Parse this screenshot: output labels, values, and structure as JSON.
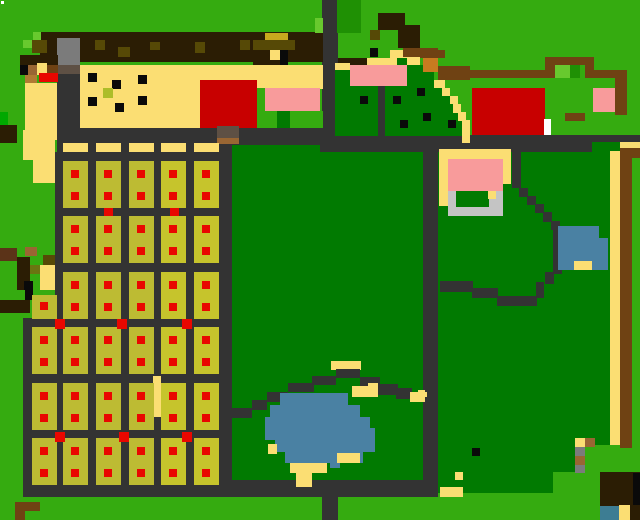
{
  "scene": {
    "width": 640,
    "height": 520,
    "background": "#35AB10",
    "description": "pixel-art top-down farm map"
  },
  "palette": {
    "G": "#35AB10",
    "G2": "#00A800",
    "GL": "#68C92E",
    "GM": "#1F9004",
    "GD": "#017A01",
    "RD": "#333333",
    "SA": "#FBDE73",
    "OL": "#BDBB33",
    "OL2": "#C6C42C",
    "RE": "#E90700",
    "RB": "#C80000",
    "PK": "#F89B9B",
    "BL": "#4A81A3",
    "BL2": "#3D7D93",
    "GY": "#7B7B7B",
    "GYL": "#C4C4C4",
    "GYB": "#5E5044",
    "BR": "#6F4213",
    "BRD": "#2B1D04",
    "BRR": "#5B3318",
    "ORN": "#C87B20",
    "OLD": "#564906",
    "OL3": "#6A7511",
    "YDK": "#C9A81E",
    "BRM": "#996633",
    "TAN": "#B07B33",
    "BK": "#0A0A0A",
    "WH": "#FFFFFF",
    "ADB": "#ADBD29"
  },
  "rects": [
    [
      57,
      128,
      266,
      33,
      "RD"
    ],
    [
      55,
      152,
      177,
      166,
      "RD"
    ],
    [
      23,
      318,
      209,
      179,
      "RD"
    ],
    [
      232,
      145,
      88,
      335,
      "GD"
    ],
    [
      320,
      152,
      103,
      328,
      "GD"
    ],
    [
      219,
      152,
      13,
      345,
      "RD"
    ],
    [
      423,
      152,
      15,
      345,
      "RD"
    ],
    [
      438,
      152,
      172,
      320,
      "GD"
    ],
    [
      438,
      472,
      115,
      21,
      "GD"
    ],
    [
      219,
      480,
      219,
      17,
      "RD"
    ],
    [
      322,
      497,
      16,
      23,
      "RD"
    ],
    [
      322,
      0,
      16,
      152,
      "RD"
    ],
    [
      338,
      135,
      302,
      17,
      "RD"
    ],
    [
      57,
      73,
      23,
      55,
      "RD"
    ],
    [
      1,
      1,
      3,
      3,
      "WH"
    ],
    [
      0,
      112,
      8,
      13,
      "G2"
    ],
    [
      0,
      125,
      17,
      18,
      "BRD"
    ],
    [
      23,
      130,
      32,
      30,
      "SA"
    ],
    [
      33,
      160,
      22,
      23,
      "SA"
    ],
    [
      40,
      32,
      283,
      30,
      "BRD"
    ],
    [
      33,
      32,
      8,
      9,
      "GL"
    ],
    [
      23,
      40,
      10,
      8,
      "GL"
    ],
    [
      315,
      18,
      8,
      15,
      "GL"
    ],
    [
      32,
      40,
      15,
      13,
      "OLD"
    ],
    [
      95,
      40,
      10,
      10,
      "OLD"
    ],
    [
      118,
      47,
      12,
      10,
      "OLD"
    ],
    [
      150,
      42,
      10,
      8,
      "OLD"
    ],
    [
      195,
      42,
      10,
      11,
      "OLD"
    ],
    [
      265,
      33,
      23,
      8,
      "YDK"
    ],
    [
      240,
      40,
      10,
      10,
      "OLD"
    ],
    [
      253,
      40,
      42,
      10,
      "OLD"
    ],
    [
      270,
      50,
      10,
      10,
      "SA"
    ],
    [
      280,
      50,
      8,
      21,
      "BK"
    ],
    [
      253,
      62,
      27,
      9,
      "BRD"
    ],
    [
      57,
      38,
      23,
      27,
      "GY"
    ],
    [
      57,
      65,
      23,
      9,
      "GYB"
    ],
    [
      20,
      55,
      38,
      10,
      "BRD"
    ],
    [
      25,
      65,
      12,
      10,
      "BRM"
    ],
    [
      37,
      63,
      10,
      12,
      "SA"
    ],
    [
      47,
      65,
      11,
      10,
      "BR"
    ],
    [
      20,
      65,
      8,
      10,
      "BK"
    ],
    [
      39,
      73,
      19,
      9,
      "RE"
    ],
    [
      25,
      75,
      12,
      8,
      "TAN"
    ],
    [
      25,
      83,
      32,
      57,
      "SA"
    ],
    [
      80,
      65,
      243,
      20,
      "SA"
    ],
    [
      80,
      85,
      120,
      43,
      "SA"
    ],
    [
      200,
      80,
      57,
      48,
      "RB"
    ],
    [
      257,
      85,
      66,
      4,
      "SA"
    ],
    [
      257,
      88,
      8,
      38,
      "G"
    ],
    [
      265,
      88,
      55,
      23,
      "PK"
    ],
    [
      265,
      111,
      12,
      17,
      "G"
    ],
    [
      277,
      111,
      13,
      17,
      "GD"
    ],
    [
      290,
      111,
      33,
      17,
      "G"
    ],
    [
      88,
      73,
      9,
      9,
      "BK"
    ],
    [
      138,
      75,
      9,
      9,
      "BK"
    ],
    [
      112,
      80,
      9,
      9,
      "BK"
    ],
    [
      88,
      97,
      9,
      9,
      "BK"
    ],
    [
      115,
      103,
      9,
      9,
      "BK"
    ],
    [
      138,
      96,
      9,
      9,
      "BK"
    ],
    [
      103,
      88,
      10,
      10,
      "ADB"
    ],
    [
      0,
      248,
      17,
      13,
      "BRR"
    ],
    [
      25,
      247,
      12,
      9,
      "BRM"
    ],
    [
      17,
      257,
      13,
      33,
      "BRD"
    ],
    [
      43,
      255,
      12,
      10,
      "OLD"
    ],
    [
      30,
      265,
      12,
      9,
      "OL3"
    ],
    [
      40,
      265,
      15,
      25,
      "SA"
    ],
    [
      24,
      281,
      9,
      9,
      "BK"
    ],
    [
      25,
      290,
      8,
      10,
      "BK"
    ],
    [
      0,
      300,
      30,
      13,
      "BRD"
    ],
    [
      337,
      0,
      24,
      33,
      "GM"
    ],
    [
      378,
      13,
      27,
      17,
      "BRD"
    ],
    [
      398,
      25,
      22,
      23,
      "BRD"
    ],
    [
      370,
      30,
      10,
      10,
      "OLD"
    ],
    [
      370,
      48,
      8,
      9,
      "BK"
    ],
    [
      403,
      48,
      35,
      9,
      "BR"
    ],
    [
      390,
      50,
      13,
      15,
      "SA"
    ],
    [
      403,
      57,
      17,
      8,
      "SA"
    ],
    [
      338,
      58,
      29,
      9,
      "BRD"
    ],
    [
      367,
      58,
      30,
      7,
      "SA"
    ],
    [
      335,
      63,
      15,
      9,
      "SA"
    ],
    [
      397,
      58,
      10,
      8,
      "GD"
    ],
    [
      335,
      70,
      43,
      66,
      "GD"
    ],
    [
      378,
      86,
      7,
      50,
      "RD"
    ],
    [
      385,
      86,
      49,
      50,
      "GD"
    ],
    [
      407,
      65,
      27,
      23,
      "GD"
    ],
    [
      434,
      88,
      10,
      48,
      "GD"
    ],
    [
      444,
      96,
      8,
      40,
      "GD"
    ],
    [
      452,
      104,
      6,
      32,
      "GD"
    ],
    [
      450,
      120,
      12,
      16,
      "GD"
    ],
    [
      350,
      65,
      57,
      21,
      "PK"
    ],
    [
      434,
      80,
      11,
      8,
      "SA"
    ],
    [
      442,
      88,
      8,
      8,
      "SA"
    ],
    [
      450,
      96,
      8,
      8,
      "SA"
    ],
    [
      453,
      104,
      8,
      9,
      "SA"
    ],
    [
      458,
      112,
      8,
      9,
      "SA"
    ],
    [
      462,
      120,
      8,
      23,
      "SA"
    ],
    [
      360,
      96,
      8,
      8,
      "BK"
    ],
    [
      393,
      96,
      8,
      8,
      "BK"
    ],
    [
      417,
      88,
      8,
      8,
      "BK"
    ],
    [
      400,
      120,
      8,
      8,
      "BK"
    ],
    [
      423,
      113,
      8,
      8,
      "BK"
    ],
    [
      448,
      120,
      8,
      8,
      "BK"
    ],
    [
      420,
      50,
      25,
      8,
      "BR"
    ],
    [
      423,
      58,
      15,
      14,
      "ORN"
    ],
    [
      438,
      66,
      32,
      14,
      "BR"
    ],
    [
      470,
      70,
      75,
      8,
      "BR"
    ],
    [
      545,
      57,
      45,
      8,
      "BR"
    ],
    [
      545,
      65,
      10,
      13,
      "BR"
    ],
    [
      555,
      65,
      15,
      13,
      "GL"
    ],
    [
      570,
      65,
      10,
      13,
      "GM"
    ],
    [
      585,
      57,
      9,
      21,
      "BR"
    ],
    [
      594,
      70,
      31,
      8,
      "BR"
    ],
    [
      615,
      70,
      12,
      45,
      "BR"
    ],
    [
      472,
      88,
      73,
      47,
      "RB"
    ],
    [
      544,
      119,
      7,
      16,
      "WH"
    ],
    [
      593,
      88,
      22,
      24,
      "PK"
    ],
    [
      565,
      113,
      20,
      8,
      "BR"
    ],
    [
      592,
      142,
      28,
      10,
      "GD"
    ],
    [
      620,
      142,
      20,
      9,
      "SA"
    ],
    [
      620,
      148,
      20,
      10,
      "BR"
    ],
    [
      610,
      151,
      10,
      294,
      "SA"
    ],
    [
      620,
      151,
      12,
      297,
      "BR"
    ],
    [
      585,
      445,
      25,
      28,
      "G"
    ],
    [
      217,
      126,
      22,
      12,
      "GYB"
    ],
    [
      217,
      138,
      22,
      6,
      "BRM"
    ],
    [
      439,
      149,
      72,
      35,
      "SA"
    ],
    [
      439,
      184,
      9,
      22,
      "SA"
    ],
    [
      448,
      159,
      55,
      32,
      "PK"
    ],
    [
      448,
      191,
      55,
      25,
      "GYL"
    ],
    [
      456,
      191,
      33,
      16,
      "GD"
    ],
    [
      488,
      191,
      8,
      8,
      "SA"
    ],
    [
      512,
      150,
      9,
      38,
      "RD"
    ],
    [
      519,
      188,
      9,
      9,
      "RD"
    ],
    [
      527,
      196,
      9,
      9,
      "RD"
    ],
    [
      535,
      204,
      9,
      9,
      "RD"
    ],
    [
      543,
      212,
      9,
      10,
      "RD"
    ],
    [
      551,
      221,
      9,
      9,
      "RD"
    ],
    [
      553,
      228,
      9,
      46,
      "RD"
    ],
    [
      545,
      272,
      9,
      12,
      "RD"
    ],
    [
      536,
      282,
      8,
      16,
      "RD"
    ],
    [
      497,
      296,
      40,
      10,
      "RD"
    ],
    [
      472,
      288,
      26,
      10,
      "RD"
    ],
    [
      440,
      281,
      33,
      11,
      "RD"
    ],
    [
      558,
      226,
      50,
      44,
      "BL"
    ],
    [
      599,
      226,
      9,
      12,
      "GD"
    ],
    [
      574,
      261,
      18,
      9,
      "SA"
    ],
    [
      472,
      448,
      8,
      8,
      "BK"
    ],
    [
      455,
      472,
      8,
      8,
      "SA"
    ],
    [
      575,
      438,
      10,
      9,
      "SA"
    ],
    [
      585,
      438,
      10,
      9,
      "BRM"
    ],
    [
      575,
      447,
      10,
      9,
      "GY"
    ],
    [
      575,
      456,
      10,
      9,
      "BRM"
    ],
    [
      575,
      465,
      10,
      8,
      "GY"
    ],
    [
      600,
      472,
      40,
      48,
      "BRD"
    ],
    [
      633,
      473,
      7,
      32,
      "BK"
    ],
    [
      600,
      506,
      19,
      14,
      "BL2"
    ],
    [
      619,
      505,
      11,
      15,
      "SA"
    ],
    [
      418,
      390,
      7,
      12,
      "SA"
    ],
    [
      440,
      487,
      23,
      10,
      "SA"
    ],
    [
      331,
      361,
      30,
      9,
      "SA"
    ],
    [
      288,
      383,
      26,
      9,
      "RD"
    ],
    [
      312,
      376,
      24,
      9,
      "RD"
    ],
    [
      336,
      369,
      24,
      9,
      "RD"
    ],
    [
      360,
      377,
      20,
      10,
      "RD"
    ],
    [
      378,
      384,
      20,
      11,
      "RD"
    ],
    [
      396,
      388,
      16,
      11,
      "RD"
    ],
    [
      410,
      392,
      17,
      10,
      "SA"
    ],
    [
      425,
      397,
      13,
      11,
      "RD"
    ],
    [
      267,
      392,
      21,
      10,
      "RD"
    ],
    [
      252,
      400,
      15,
      10,
      "RD"
    ],
    [
      230,
      408,
      22,
      10,
      "RD"
    ],
    [
      352,
      386,
      26,
      11,
      "SA"
    ],
    [
      368,
      383,
      10,
      14,
      "SA"
    ],
    [
      280,
      393,
      68,
      12,
      "BL"
    ],
    [
      270,
      405,
      90,
      12,
      "BL"
    ],
    [
      265,
      417,
      105,
      11,
      "BL"
    ],
    [
      265,
      428,
      110,
      12,
      "BL"
    ],
    [
      275,
      440,
      100,
      12,
      "BL"
    ],
    [
      285,
      452,
      78,
      11,
      "BL"
    ],
    [
      330,
      463,
      10,
      5,
      "BL"
    ],
    [
      268,
      444,
      9,
      10,
      "SA"
    ],
    [
      290,
      463,
      37,
      10,
      "SA"
    ],
    [
      296,
      473,
      16,
      14,
      "SA"
    ],
    [
      337,
      453,
      23,
      10,
      "SA"
    ],
    [
      15,
      502,
      25,
      9,
      "BR"
    ],
    [
      15,
      511,
      10,
      9,
      "BR"
    ],
    [
      153,
      376,
      8,
      41,
      "SA"
    ]
  ],
  "plots": {
    "plot_w": 25,
    "plot_h": 47,
    "rows_upper": [
      161,
      216,
      272
    ],
    "cols_upper": [
      63,
      96,
      129,
      161,
      194
    ],
    "rows_lower": [
      327,
      383,
      438
    ],
    "cols_lower": [
      32,
      63,
      96,
      129,
      161,
      194
    ],
    "partial_plot": [
      32,
      295,
      25,
      24
    ],
    "partial_dot": [
      40,
      302
    ],
    "bright_from_x": 161,
    "color": "OL",
    "color_bright": "OL2",
    "dot_color": "RE",
    "dot_size": 8,
    "dot_offset_x": 8,
    "dot_offsets_y": [
      9,
      31
    ],
    "top_bars_y": 143,
    "top_bars_h": 9,
    "road_dot_size": 10,
    "road_dots": [
      [
        55,
        319
      ],
      [
        117,
        319
      ],
      [
        182,
        319
      ],
      [
        55,
        432
      ],
      [
        119,
        432
      ],
      [
        182,
        432
      ]
    ],
    "connector_size": [
      9,
      8
    ],
    "connectors": [
      [
        104,
        208
      ],
      [
        170,
        208
      ]
    ]
  }
}
